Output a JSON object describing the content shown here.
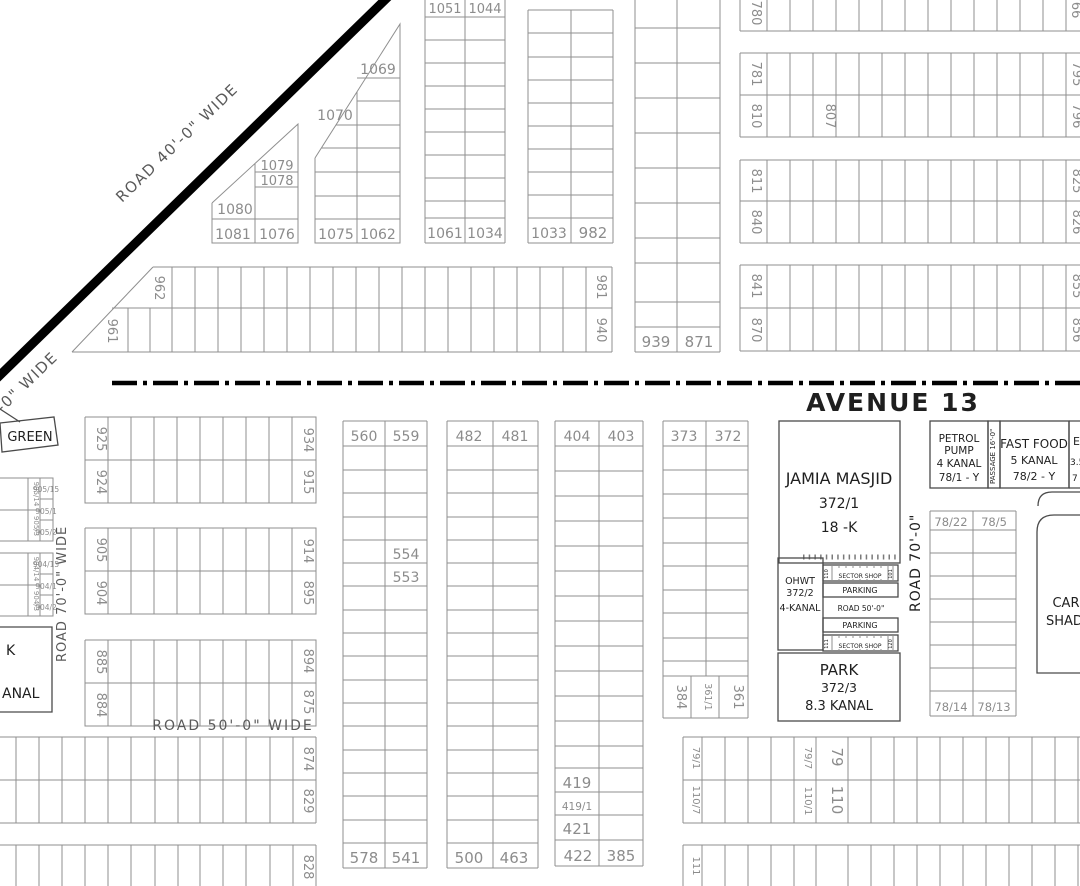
{
  "colors": {
    "arrow_red": "#e8190f",
    "grid_gray": "#8f8f8f",
    "road_black": "#000000",
    "label_gray": "#8c8c8c"
  },
  "roads": {
    "avenue13": "AVENUE 13",
    "road40": "ROAD 40'-0\" WIDE",
    "road40_fragment": "-0\" WIDE",
    "road70_left": "ROAD 70'-0\" WIDE",
    "road70_right": "ROAD 70'-0\"",
    "road50_wide": "ROAD 50'-0\" WIDE",
    "road50_inner": "ROAD 50'-0\"",
    "passage16": "PASSAGE 16'-0\""
  },
  "facilities": {
    "green": "GREEN",
    "jamia": {
      "l1": "JAMIA MASJID",
      "l2": "372/1",
      "l3": "18 -K"
    },
    "petrol": {
      "l1": "PETROL",
      "l2": "PUMP",
      "l3": "4 KANAL",
      "l4": "78/1 - Y"
    },
    "fastfood": {
      "l1": "FAST FOOD",
      "l2": "5 KANAL",
      "l3": "78/2 - Y"
    },
    "edge_box": {
      "l1": "E",
      "l2": "3.5",
      "l3": "7"
    },
    "ohwt": {
      "l1": "OHWT",
      "l2": "372/2",
      "l3": "4-KANAL"
    },
    "park": {
      "l1": "PARK",
      "l2": "372/3",
      "l3": "8.3 KANAL"
    },
    "park_cut": {
      "l1": "K",
      "l2": "ANAL"
    },
    "car": {
      "l1": "CAR",
      "l2": "SHAD"
    },
    "parking": "PARKING",
    "sector_shop": "SECTOR SHOP",
    "shop_no_110": "110",
    "shop_no_101": "101",
    "shop_no_111": "111",
    "shop_no_120": "120"
  },
  "plots": {
    "p1069": "1069",
    "p1070": "1070",
    "p1079": "1079",
    "p1078": "1078",
    "p1080": "1080",
    "p1081": "1081",
    "p1076": "1076",
    "p1075": "1075",
    "p1062": "1062",
    "p1051": "1051",
    "p1044": "1044",
    "p1061": "1061",
    "p1034": "1034",
    "p1033": "1033",
    "p982": "982",
    "p939": "939",
    "p871": "871",
    "p962": "962",
    "p961": "961",
    "p981": "981",
    "p940": "940",
    "p780": "780",
    "p766": "766",
    "p781": "781",
    "p810": "810",
    "p807": "807",
    "p795": "795",
    "p796": "796",
    "p811": "811",
    "p840": "840",
    "p825": "825",
    "p826": "826",
    "p841": "841",
    "p870": "870",
    "p855": "855",
    "p856": "856",
    "p925": "925",
    "p924": "924",
    "p934": "934",
    "p915": "915",
    "p905": "905",
    "p904": "904",
    "p914": "914",
    "p895": "895",
    "p885": "885",
    "p884": "884",
    "p894": "894",
    "p875": "875",
    "p874": "874",
    "p829": "829",
    "p828": "828",
    "p905_15": "905/15",
    "p905_1": "905/1",
    "p905_2": "905/2",
    "p905_14": "905/14",
    "p905_3": "905/3",
    "p904_15": "904/15",
    "p904_1": "904/1",
    "p904_2": "904/2",
    "p904_14": "904/14",
    "p904_3": "904/3",
    "p560": "560",
    "p559": "559",
    "p554": "554",
    "p553": "553",
    "p578": "578",
    "p541": "541",
    "p482": "482",
    "p481": "481",
    "p500": "500",
    "p463": "463",
    "p404": "404",
    "p403": "403",
    "p419": "419",
    "p419_1": "419/1",
    "p421": "421",
    "p422": "422",
    "p385": "385",
    "p373": "373",
    "p372": "372",
    "p384": "384",
    "p361_1": "361/1",
    "p361": "361",
    "p78_22": "78/22",
    "p78_5": "78/5",
    "p78_14": "78/14",
    "p78_13": "78/13",
    "p79_1": "79/1",
    "p110_7": "110/7",
    "p79_7": "79/7",
    "p110_1": "110/1",
    "p79": "79",
    "p110": "110",
    "p111": "111"
  }
}
